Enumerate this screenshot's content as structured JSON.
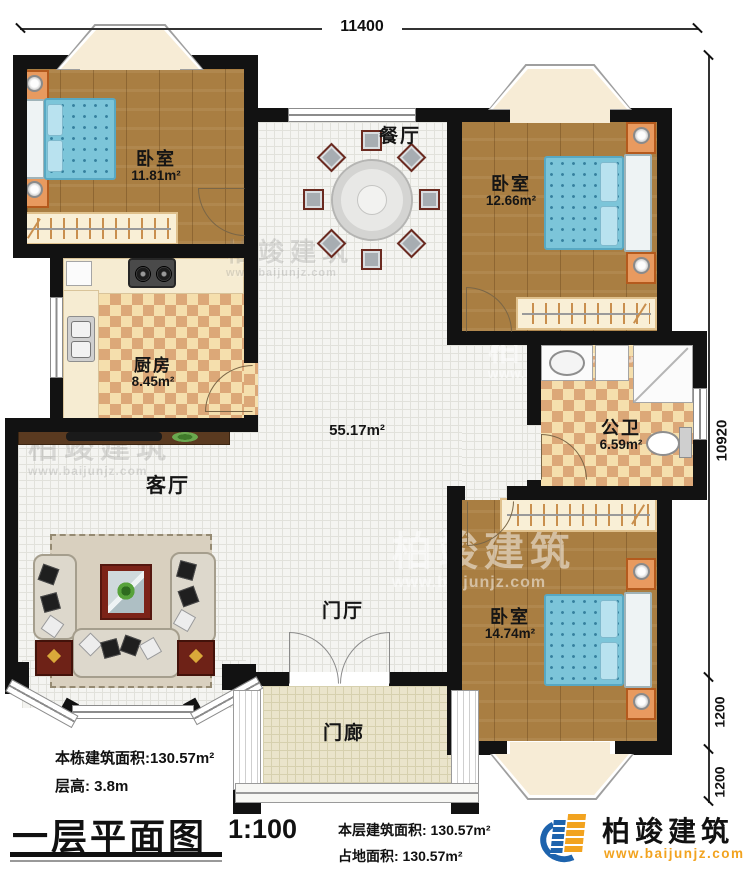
{
  "plan": {
    "title": "一层平面图",
    "scale": "1:100",
    "dims": {
      "top_width": "11400",
      "right_height": "10920",
      "bay_a": "1200",
      "bay_b": "1200"
    },
    "rooms": {
      "bedroom1": {
        "name": "卧室",
        "area": "11.81m²"
      },
      "bedroom2": {
        "name": "卧室",
        "area": "12.66m²"
      },
      "bedroom3": {
        "name": "卧室",
        "area": "14.74m²"
      },
      "kitchen": {
        "name": "厨房",
        "area": "8.45m²"
      },
      "bath": {
        "name": "公卫",
        "area": "6.59m²"
      },
      "dining": {
        "name": "餐厅"
      },
      "living": {
        "name": "客厅"
      },
      "foyer": {
        "name": "门厅"
      },
      "porch": {
        "name": "门廊"
      },
      "hall_area": "55.17m²"
    },
    "notes": {
      "building_area": "本栋建筑面积:130.57m²",
      "floor_height": "层高: 3.8m",
      "floor_area_label": "本层建筑面积: 130.57m²",
      "ground_area_label": "占地面积: 130.57m²"
    }
  },
  "brand": {
    "name": "柏竣建筑",
    "url": "www.baijunjz.com"
  },
  "watermark": {
    "name": "柏竣建筑",
    "url": "www.baijunjz.com"
  },
  "colors": {
    "wall": "#121212",
    "wood_floor": "#a97e42",
    "checker_light": "#f5dfad",
    "checker_dark": "#dca878",
    "bed_blue": "#7cc5d9",
    "brand_blue": "#1d63ad",
    "brand_orange": "#f2a31f"
  }
}
